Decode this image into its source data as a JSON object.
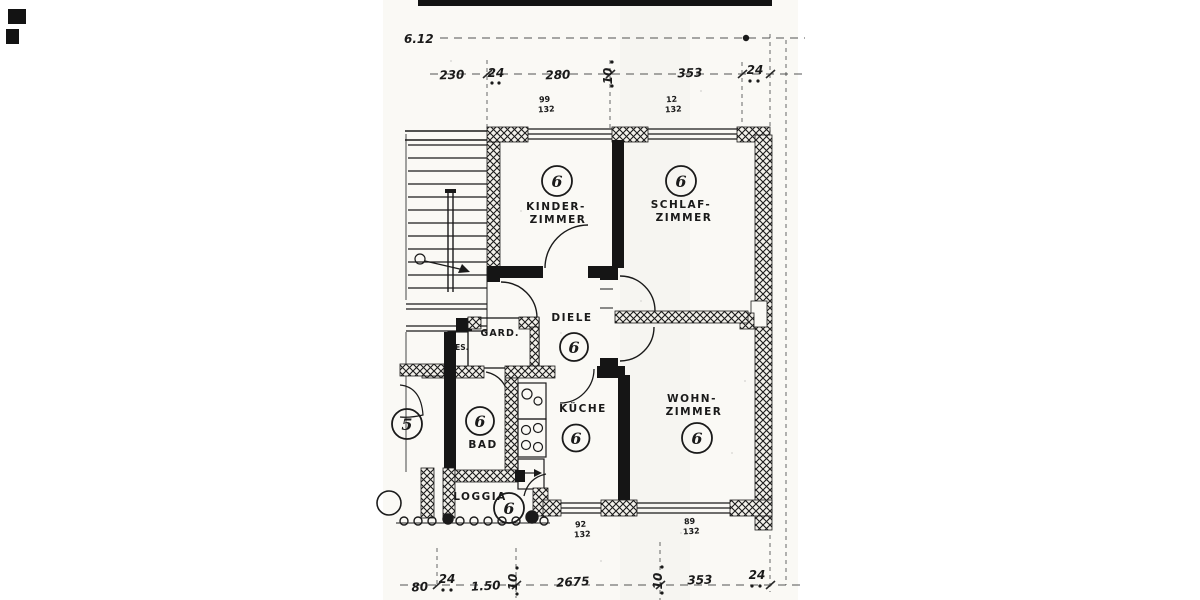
{
  "plan": {
    "overall_width_label": "6.12",
    "rooms": {
      "kinderzimmer": {
        "label_line1": "KINDER-",
        "label_line2": "ZIMMER",
        "number": "6"
      },
      "schlafzimmer": {
        "label_line1": "SCHLAF-",
        "label_line2": "ZIMMER",
        "number": "6"
      },
      "diele": {
        "label": "DIELE",
        "number": "6"
      },
      "wohnzimmer": {
        "label_line1": "WOHN-",
        "label_line2": "ZIMMER",
        "number": "6"
      },
      "kueche": {
        "label": "KÜCHE",
        "number": "6"
      },
      "bad": {
        "label": "BAD",
        "number": "6"
      },
      "loggia": {
        "label": "LOGGIA",
        "number": "6"
      },
      "garderobe": {
        "label": "GARD."
      },
      "besenkammer": {
        "label": "BES."
      },
      "neighbor_unit": {
        "number": "5"
      }
    },
    "dimensions": {
      "top": [
        "230",
        "24",
        "280",
        "10",
        "353",
        "24"
      ],
      "bottom": [
        "80",
        "24",
        "1.50",
        "10",
        "2675",
        "10",
        "353",
        "24"
      ]
    },
    "window_notes": [
      {
        "top": "99",
        "bottom": "132"
      },
      {
        "top": "12",
        "bottom": "132"
      },
      {
        "top": "92",
        "bottom": "132"
      },
      {
        "top": "89",
        "bottom": "132"
      }
    ],
    "colors": {
      "ink": "#1a1a1a",
      "paper": "#faf9f5"
    }
  }
}
